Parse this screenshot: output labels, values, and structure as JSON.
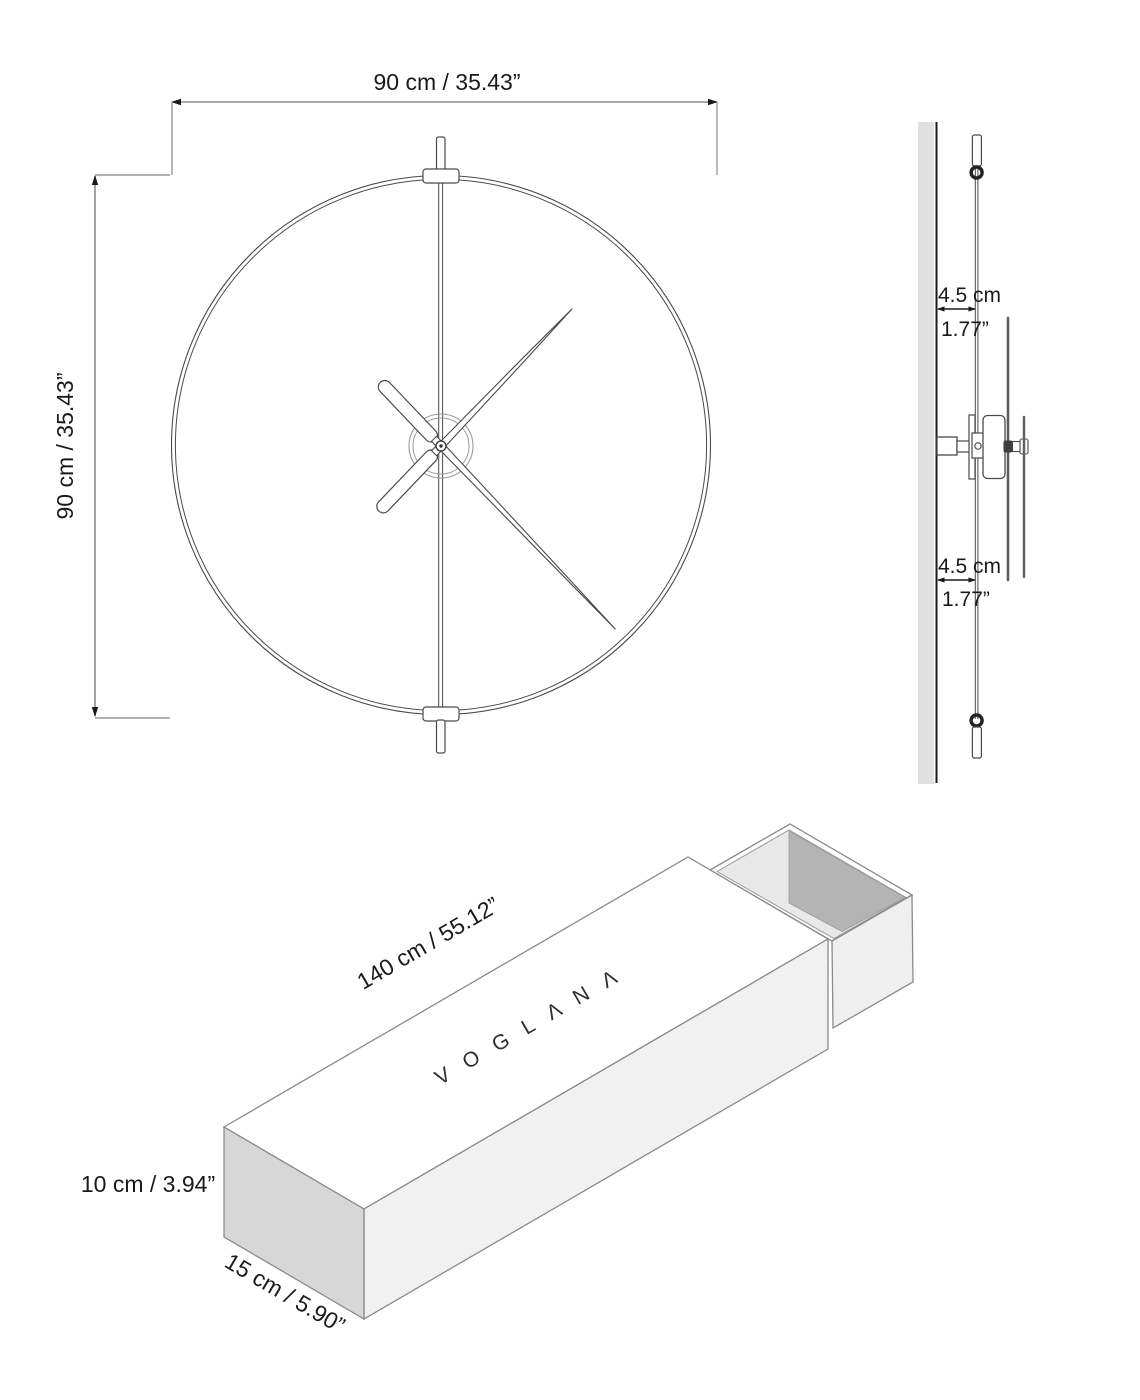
{
  "drawing_title": "Wall clock dimension drawing",
  "front_view": {
    "description": "front view of minimalist ring wall clock",
    "width_label": "90 cm / 35.43”",
    "height_label": "90 cm / 35.43”"
  },
  "side_view": {
    "description": "side profile on wall showing offset",
    "top_offset_cm": "4.5 cm",
    "top_offset_in": "1.77”",
    "bottom_offset_cm": "4.5 cm",
    "bottom_offset_in": "1.77”"
  },
  "box_view": {
    "description": "packaging sleeve box with sliding tray",
    "brand": "VOGLANA",
    "brand_display": "V O G L Λ N Λ",
    "length_label": "140 cm / 55.12”",
    "height_label": "10 cm / 3.94”",
    "depth_label": "15 cm / 5.90”"
  },
  "colors": {
    "ink": "#1a1a1a",
    "dimension_line": "#8c8c8c",
    "drawing_line": "#4a4a4a",
    "light_line": "#9a9a9a",
    "wall_fill": "#e0e0e0",
    "box_end_fill": "#d7d7d7",
    "box_front_fill": "#f1f1f1",
    "tray_inner_light": "#e8e8e8",
    "tray_inner_dark": "#b4b4b4",
    "tray_outer_fill": "#efefef",
    "hand_profile": "#5e5e5e"
  }
}
